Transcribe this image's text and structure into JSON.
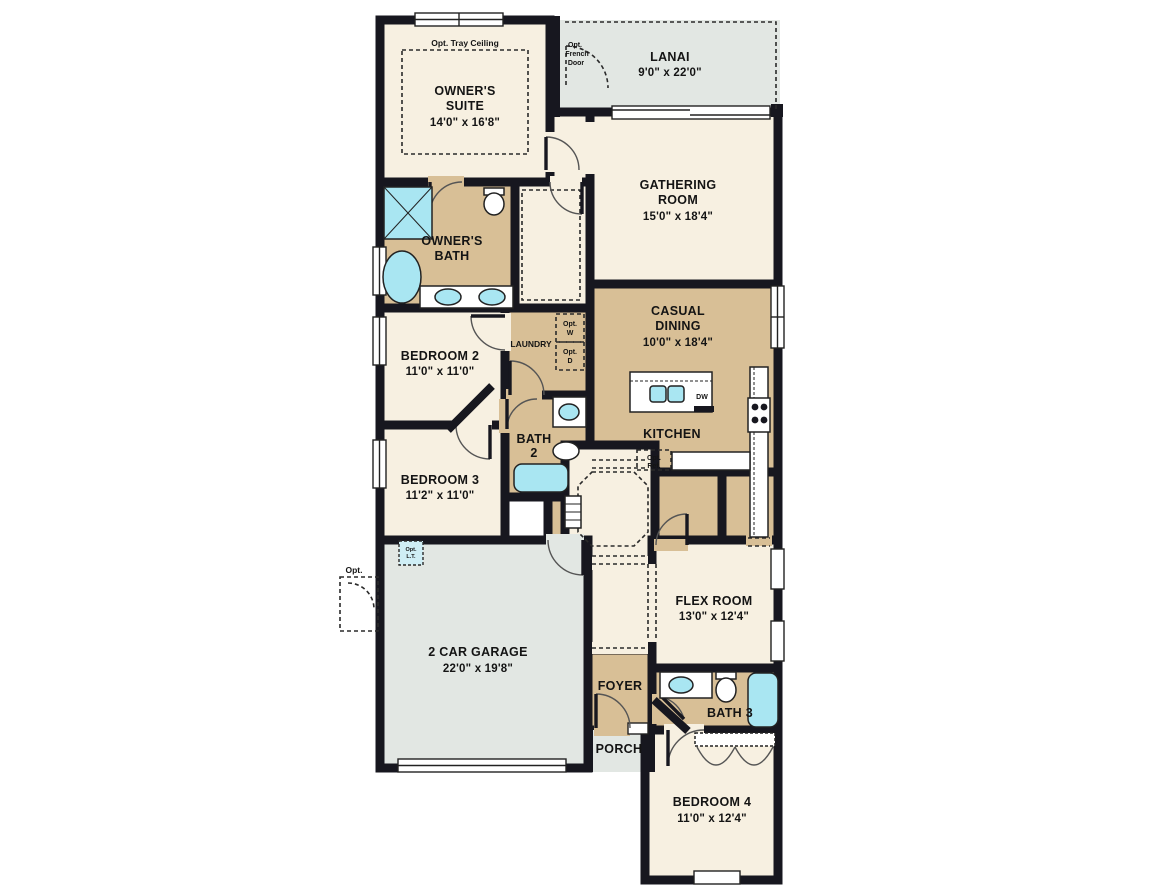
{
  "plan": {
    "type": "residential-floor-plan",
    "colors": {
      "wall": "#17171f",
      "room_cream": "#f7f0e1",
      "room_tan": "#d8bf96",
      "outdoor_gray": "#e2e7e3",
      "fixture_blue": "#a9e6f2",
      "white": "#ffffff"
    },
    "rooms": {
      "owners_suite": {
        "line1": "OWNER'S",
        "line2": "SUITE",
        "dims": "14'0\" x 16'8\"",
        "tray_note": "Opt. Tray Ceiling"
      },
      "lanai": {
        "line1": "LANAI",
        "dims": "9'0\" x 22'0\"",
        "fd1": "Opt.",
        "fd2": "French",
        "fd3": "Door"
      },
      "gathering": {
        "line1": "GATHERING",
        "line2": "ROOM",
        "dims": "15'0\" x 18'4\""
      },
      "owners_bath": {
        "line1": "OWNER'S",
        "line2": "BATH"
      },
      "bedroom2": {
        "line1": "BEDROOM 2",
        "dims": "11'0\" x 11'0\""
      },
      "bedroom3": {
        "line1": "BEDROOM 3",
        "dims": "11'2\" x 11'0\""
      },
      "laundry": {
        "line1": "LAUNDRY",
        "w1": "Opt.",
        "w2": "W",
        "d1": "Opt.",
        "d2": "D"
      },
      "casual_dining": {
        "line1": "CASUAL",
        "line2": "DINING",
        "dims": "10'0\" x 18'4\""
      },
      "kitchen": {
        "line1": "KITCHEN",
        "dw": "DW",
        "ref1": "Opt.",
        "ref2": "Ref."
      },
      "bath2": {
        "line1": "BATH",
        "line2": "2"
      },
      "garage": {
        "line1": "2 CAR GARAGE",
        "dims": "22'0\" x 19'8\"",
        "lt1": "Opt.",
        "lt2": "L.T.",
        "side_door": "Opt."
      },
      "flex": {
        "line1": "FLEX ROOM",
        "dims": "13'0\" x 12'4\""
      },
      "foyer": {
        "line1": "FOYER"
      },
      "porch": {
        "line1": "PORCH"
      },
      "bath3": {
        "line1": "BATH 3"
      },
      "bedroom4": {
        "line1": "BEDROOM 4",
        "dims": "11'0\" x 12'4\""
      }
    }
  }
}
